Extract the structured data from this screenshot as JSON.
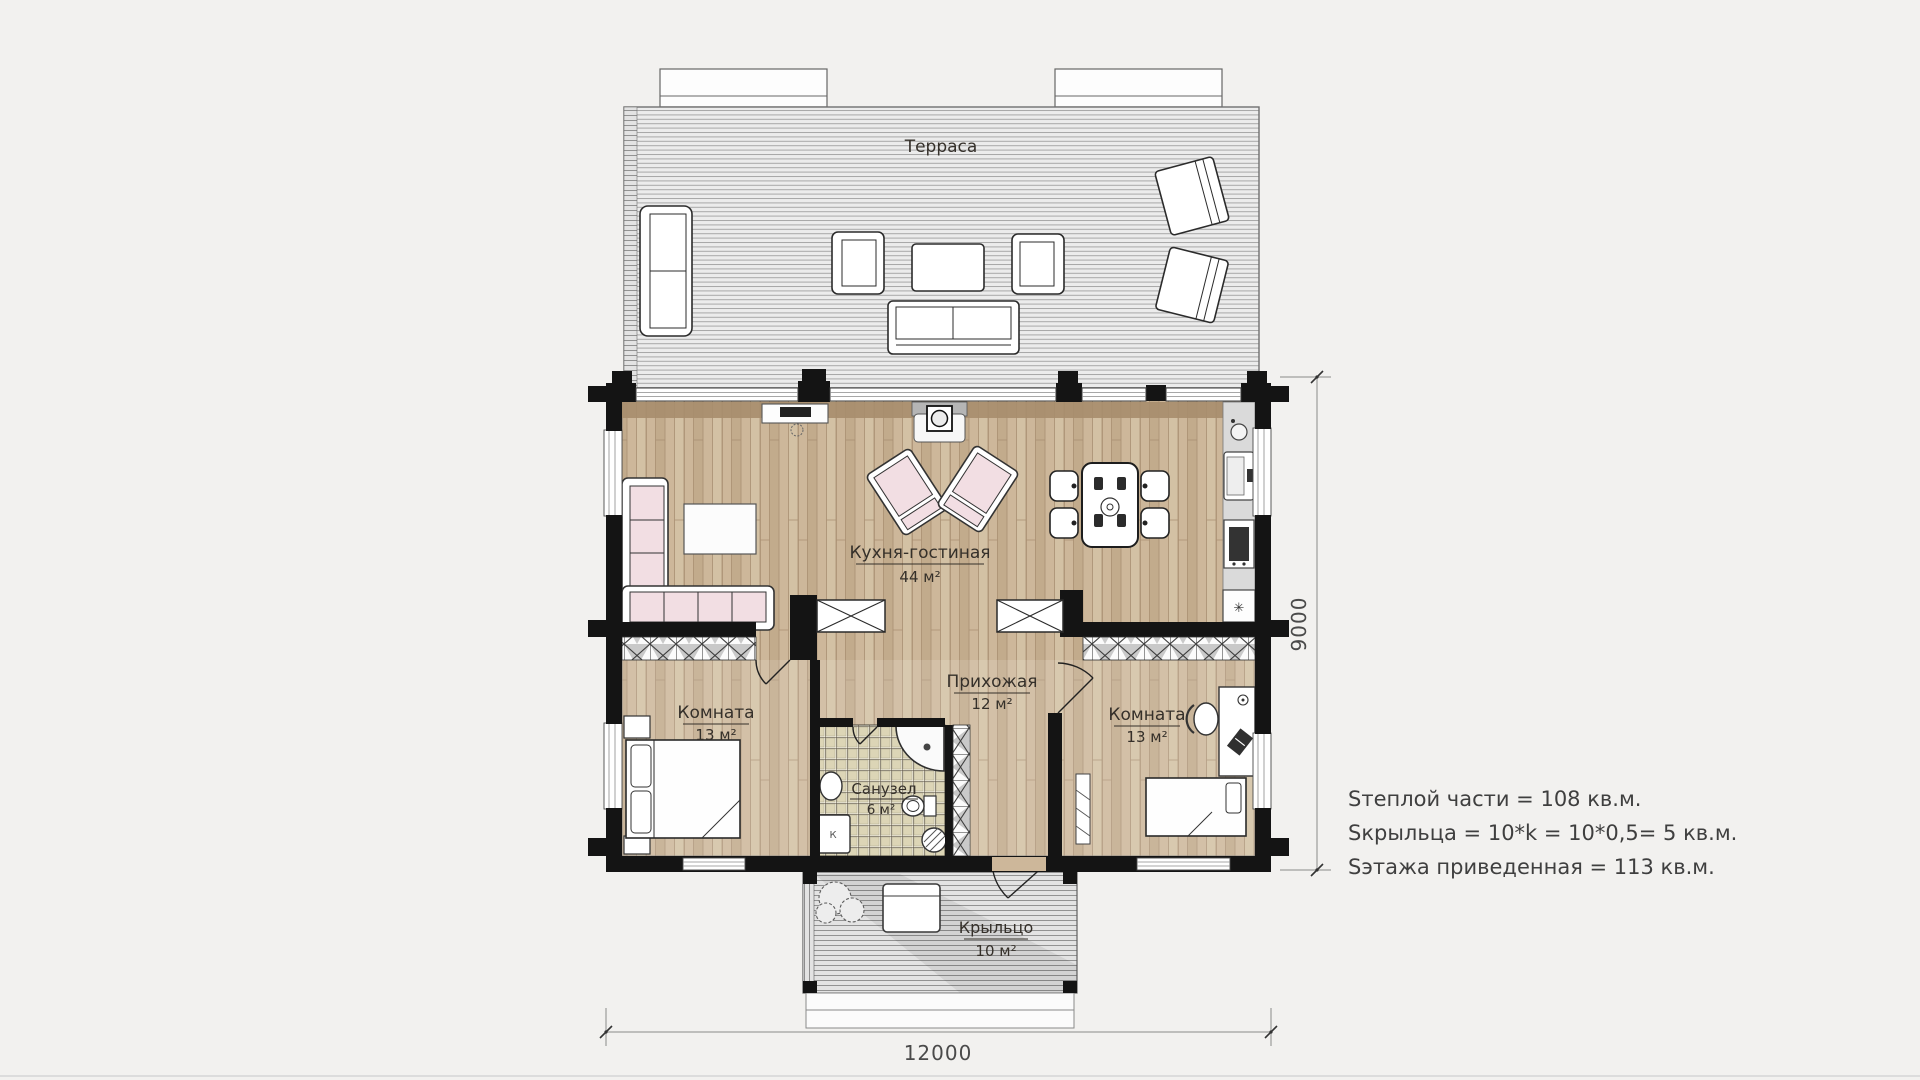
{
  "page": {
    "background": "#f2f1ef",
    "bottom_rule_color": "#dcdcdc"
  },
  "plan": {
    "terrace": {
      "name": "Терраса"
    },
    "kitchen_living": {
      "name": "Кухня-гостиная",
      "area": "44 м²"
    },
    "hallway": {
      "name": "Прихожая",
      "area": "12 м²"
    },
    "bedroom_left": {
      "name": "Комната",
      "area": "13 м²"
    },
    "bedroom_right": {
      "name": "Комната",
      "area": "13 м²"
    },
    "bathroom": {
      "name": "Санузел",
      "area": "6 м²",
      "appliance_label": "К"
    },
    "porch": {
      "name": "Крыльцо",
      "area": "10 м²"
    },
    "icons": {
      "fridge_snowflake": "✳"
    }
  },
  "dimensions": {
    "width_mm": "12000",
    "height_mm": "9000"
  },
  "notes": {
    "line1": "Sтеплой части = 108 кв.м.",
    "line2": "Sкрыльца = 10*k = 10*0,5= 5 кв.м.",
    "line3": "Sэтажа приведенная = 113 кв.м."
  },
  "colors": {
    "wall": "#141414",
    "wood_floor": "#cdb79a",
    "wood_band": "#a78d6d",
    "terrace_deck": "#ececec",
    "furniture_pink": "#f2dee3",
    "tile": "#dcd5b6"
  }
}
